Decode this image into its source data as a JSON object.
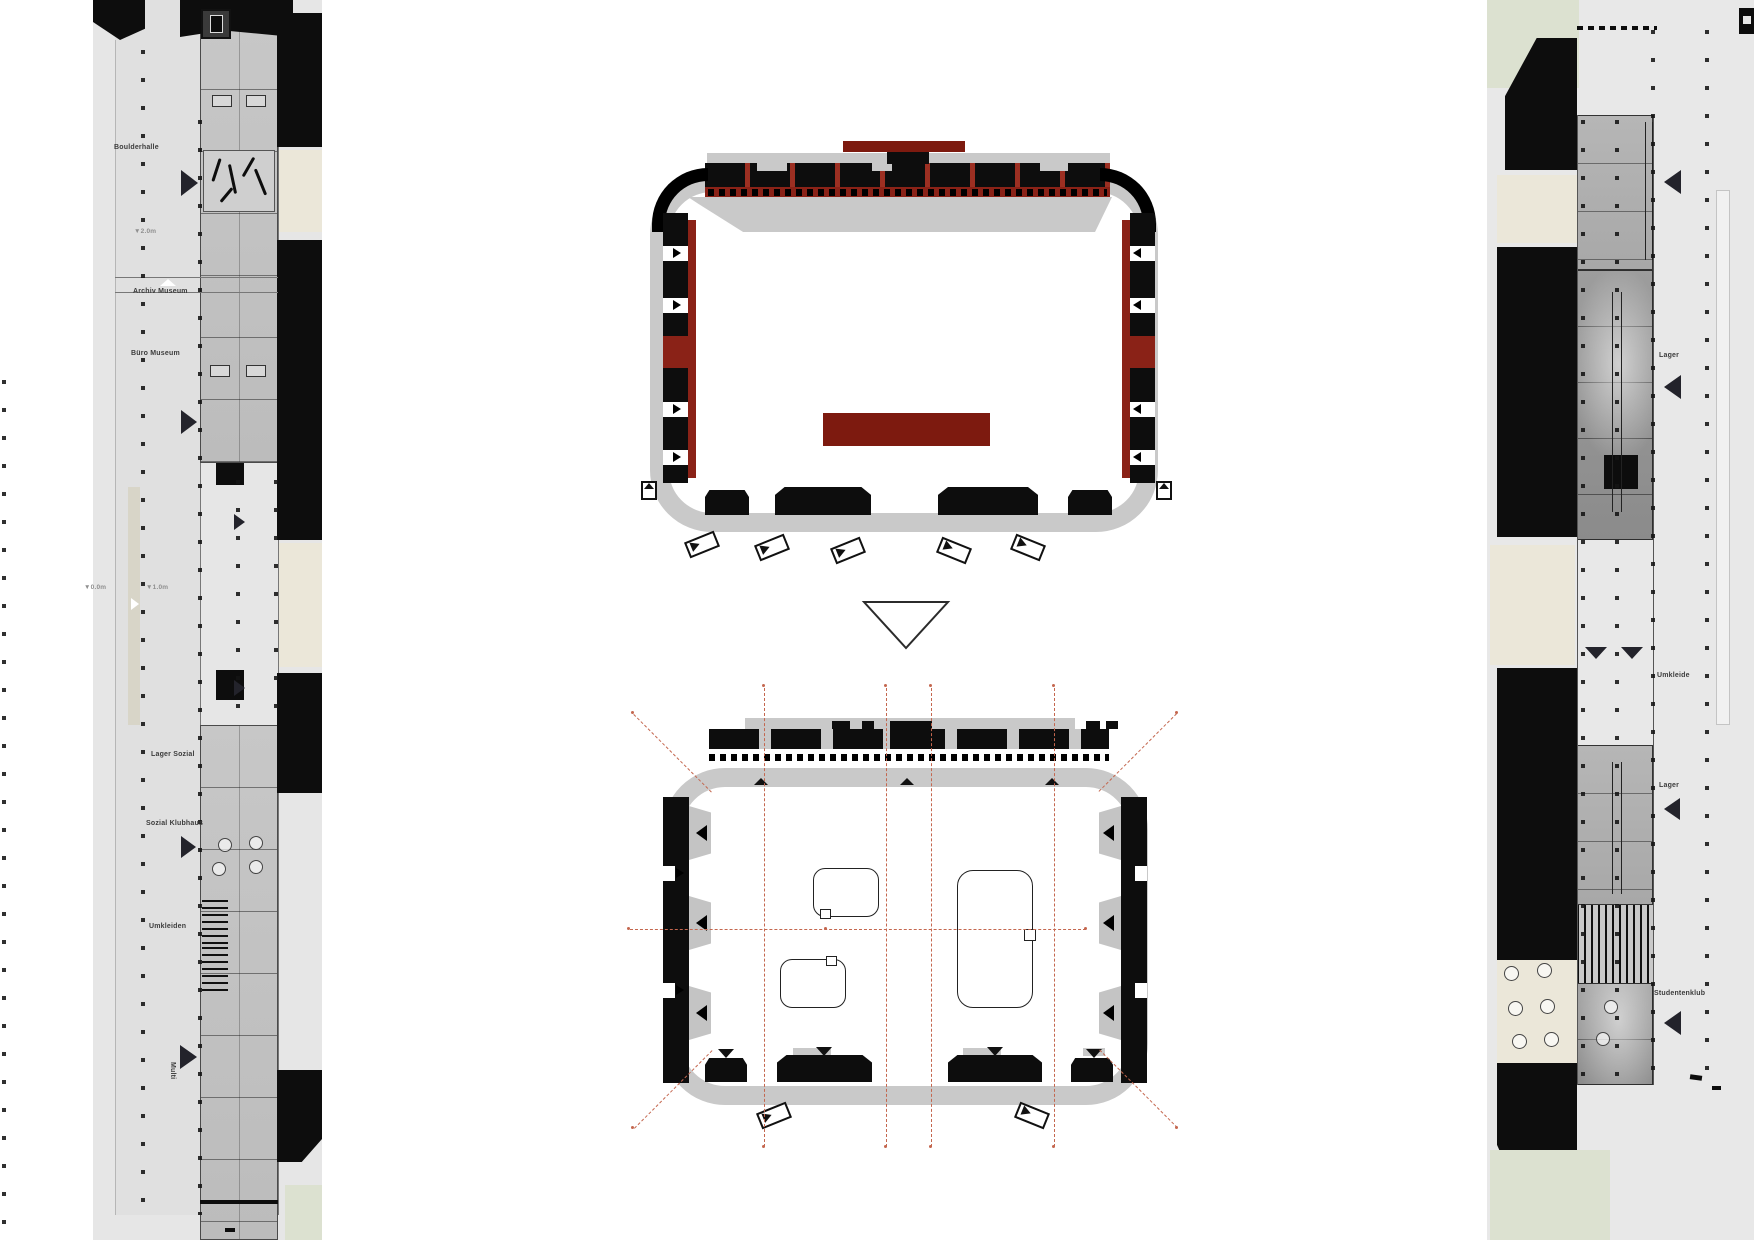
{
  "sheet": {
    "title_hint": "architectural floor plan sheet"
  },
  "palette": {
    "maroon": "#8a2217",
    "banner_red": "#7d1a0f",
    "separator_red": "#9c2f22",
    "band_gray": "#c9c9c9",
    "panel_gray": "#e6e6e6",
    "cream": "#ebe7d9",
    "pale_green": "#dce1d0",
    "axis_red": "#c4674f",
    "ink": "#0d0d0d",
    "label": "#3c3c3c",
    "muted_label": "#8f8f8f"
  },
  "left_wing": {
    "labels": {
      "boulderhalle": "Boulderhalle",
      "level_minus": "▼2.0m",
      "archiv": "Archiv Museum",
      "buero": "Büro Museum",
      "level_zero": "▼0.0m",
      "level_one": "▼1.0m",
      "lager_sozial": "Lager Sozial",
      "sozial_klubhaus": "Sozial Klubhaus",
      "umkleiden": "Umkleiden",
      "multi": "Multi"
    }
  },
  "right_wing": {
    "labels": {
      "lager_top": "Lager",
      "umkleide": "Umkleide",
      "lager_mid": "Lager",
      "studentenklub": "Studentenklub"
    }
  }
}
